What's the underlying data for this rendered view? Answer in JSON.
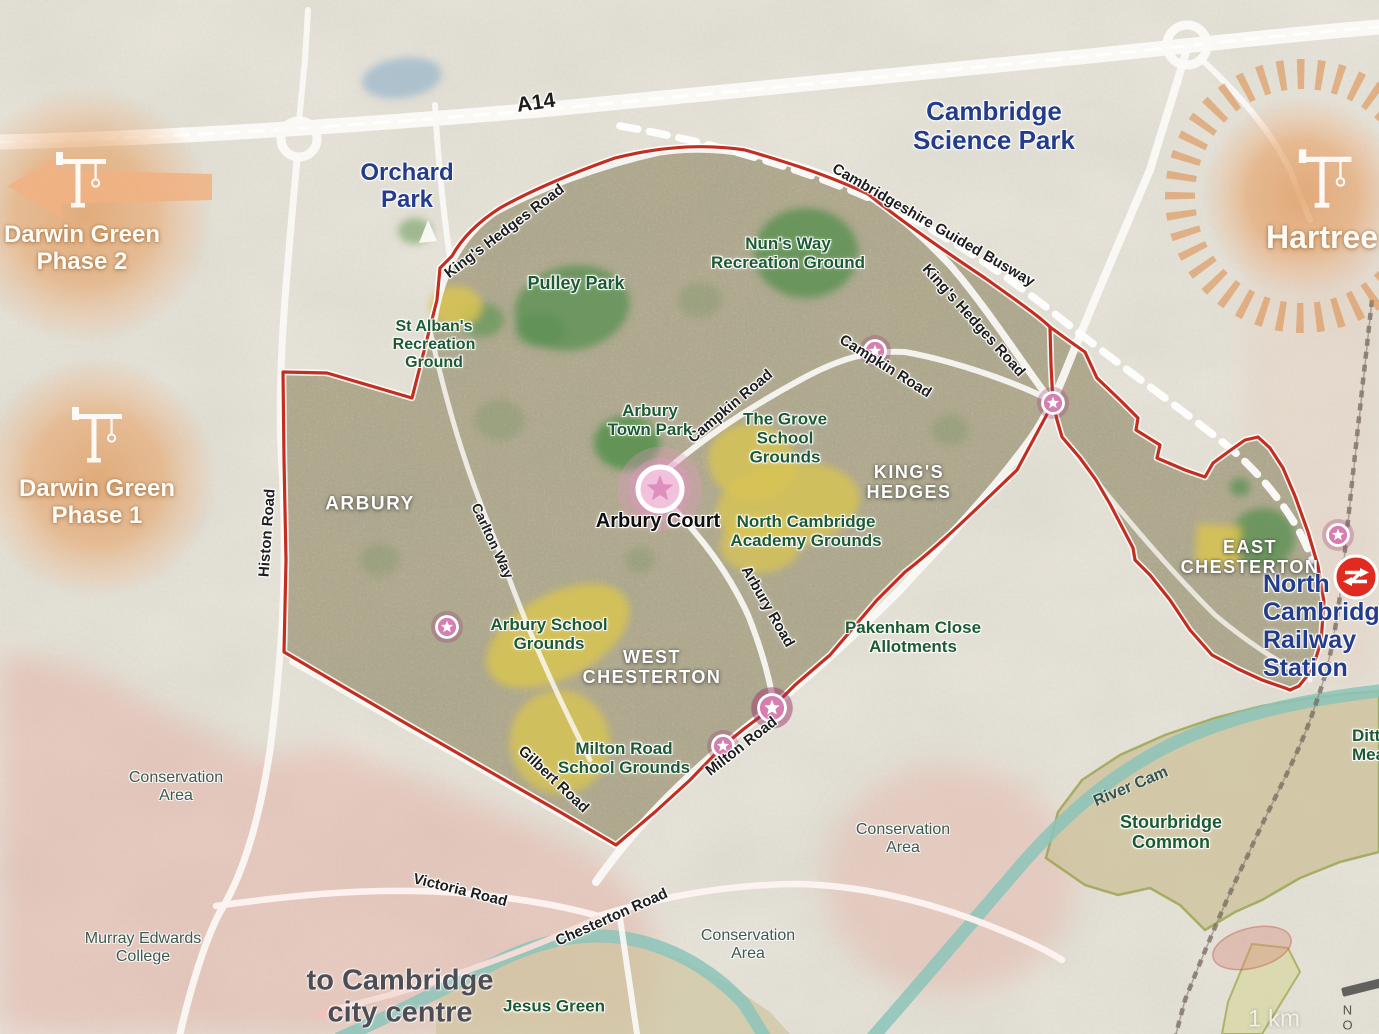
{
  "map_title": "North Cambridge area map",
  "colors": {
    "boundary_red": "#c22f21",
    "water_teal": "#8cc4ba",
    "development_orange": "#e9a873",
    "marker_pink": "#d47fae",
    "rail_red": "#e02c20",
    "label_navy": "#243d8b",
    "label_green": "#1c5a33",
    "region_white": "#ffffff",
    "field_yellow": "#d8c452",
    "park_green": "#5d9154",
    "common_tan": "#cfc49f"
  },
  "scale": {
    "label": "1 km"
  },
  "compass": {
    "label": "N O"
  },
  "labels": [
    {
      "name": "road-label-a14",
      "text": "A14",
      "x": 536,
      "y": 103,
      "rot": -8,
      "size": 21,
      "cls": "road"
    },
    {
      "name": "road-label-kings-hedges-west",
      "text": "King's Hedges Road",
      "x": 505,
      "y": 232,
      "rot": -37,
      "size": 15,
      "cls": "road"
    },
    {
      "name": "road-label-kings-hedges-east",
      "text": "King's Hedges Road",
      "x": 973,
      "y": 321,
      "rot": 48,
      "size": 15,
      "cls": "road"
    },
    {
      "name": "road-label-guided-busway",
      "text": "Cambridgeshire Guided Busway",
      "x": 933,
      "y": 226,
      "rot": 30,
      "size": 15,
      "cls": "road"
    },
    {
      "name": "road-label-campkin-west",
      "text": "Campkin Road",
      "x": 731,
      "y": 407,
      "rot": -40,
      "size": 15,
      "cls": "road"
    },
    {
      "name": "road-label-campkin-east",
      "text": "Campkin Road",
      "x": 885,
      "y": 367,
      "rot": 32,
      "size": 15,
      "cls": "road"
    },
    {
      "name": "road-label-histon",
      "text": "Histon Road",
      "x": 268,
      "y": 533,
      "rot": -86,
      "size": 15,
      "cls": "road"
    },
    {
      "name": "road-label-carlton-way",
      "text": "Carlton Way",
      "x": 492,
      "y": 541,
      "rot": 65,
      "size": 14,
      "cls": "road"
    },
    {
      "name": "road-label-arbury-road",
      "text": "Arbury Road",
      "x": 767,
      "y": 607,
      "rot": 60,
      "size": 15,
      "cls": "road"
    },
    {
      "name": "road-label-milton-road",
      "text": "Milton Road",
      "x": 742,
      "y": 747,
      "rot": -38,
      "size": 15,
      "cls": "road"
    },
    {
      "name": "road-label-gilbert-road",
      "text": "Gilbert Road",
      "x": 553,
      "y": 780,
      "rot": 43,
      "size": 15,
      "cls": "road"
    },
    {
      "name": "road-label-victoria-road",
      "text": "Victoria Road",
      "x": 460,
      "y": 891,
      "rot": 14,
      "size": 15,
      "cls": "road"
    },
    {
      "name": "road-label-chesterton-road",
      "text": "Chesterton Road",
      "x": 612,
      "y": 918,
      "rot": -24,
      "size": 15,
      "cls": "road"
    },
    {
      "name": "river-cam-label",
      "text": "River Cam",
      "x": 1131,
      "y": 787,
      "rot": -23,
      "size": 16,
      "cls": "river"
    },
    {
      "name": "orchard-park-label",
      "text": "Orchard\nPark",
      "x": 407,
      "y": 187,
      "rot": 0,
      "size": 24,
      "cls": "navy"
    },
    {
      "name": "cambridge-science-park-label",
      "text": "Cambridge\nScience Park",
      "x": 994,
      "y": 126,
      "rot": 0,
      "size": 26,
      "cls": "navy"
    },
    {
      "name": "north-cambridge-station-label",
      "text": "North Cambridge\nRailway Station",
      "x": 1263,
      "y": 626,
      "rot": 0,
      "size": 25,
      "cls": "navy",
      "align": "left"
    },
    {
      "name": "darwin-green-phase-2-label",
      "text": "Darwin Green\nPhase 2",
      "x": 82,
      "y": 249,
      "rot": 0,
      "size": 24,
      "cls": "white-big"
    },
    {
      "name": "darwin-green-phase-1-label",
      "text": "Darwin Green\nPhase 1",
      "x": 97,
      "y": 503,
      "rot": 0,
      "size": 24,
      "cls": "white-big"
    },
    {
      "name": "hartree-label",
      "text": "Hartree",
      "x": 1322,
      "y": 238,
      "rot": 0,
      "size": 32,
      "cls": "white-big"
    },
    {
      "name": "region-label-arbury",
      "text": "ARBURY",
      "x": 370,
      "y": 504,
      "rot": 0,
      "size": 19,
      "cls": "region"
    },
    {
      "name": "region-label-kings-hedges",
      "text": "KING'S\nHEDGES",
      "x": 909,
      "y": 482,
      "rot": 0,
      "size": 18,
      "cls": "region"
    },
    {
      "name": "region-label-west-chesterton",
      "text": "WEST\nCHESTERTON",
      "x": 652,
      "y": 667,
      "rot": 0,
      "size": 18,
      "cls": "region"
    },
    {
      "name": "region-label-east-chesterton",
      "text": "EAST\nCHESTERTON",
      "x": 1250,
      "y": 557,
      "rot": 0,
      "size": 18,
      "cls": "region"
    },
    {
      "name": "pulley-park-label",
      "text": "Pulley Park",
      "x": 576,
      "y": 283,
      "rot": 0,
      "size": 18,
      "cls": "green"
    },
    {
      "name": "nuns-way-recreation-label",
      "text": "Nun's Way\nRecreation Ground",
      "x": 788,
      "y": 253,
      "rot": 0,
      "size": 17,
      "cls": "green"
    },
    {
      "name": "st-albans-recreation-label",
      "text": "St Alban's\nRecreation\nGround",
      "x": 434,
      "y": 345,
      "rot": 0,
      "size": 16,
      "cls": "green"
    },
    {
      "name": "arbury-town-park-label",
      "text": "Arbury\nTown Park",
      "x": 650,
      "y": 420,
      "rot": 0,
      "size": 17,
      "cls": "green"
    },
    {
      "name": "grove-school-grounds-label",
      "text": "The Grove\nSchool\nGrounds",
      "x": 785,
      "y": 438,
      "rot": 0,
      "size": 17,
      "cls": "green"
    },
    {
      "name": "north-cambridge-academy-label",
      "text": "North Cambridge\nAcademy  Grounds",
      "x": 806,
      "y": 531,
      "rot": 0,
      "size": 17,
      "cls": "green"
    },
    {
      "name": "arbury-school-grounds-label",
      "text": "Arbury School\nGrounds",
      "x": 549,
      "y": 634,
      "rot": 0,
      "size": 17,
      "cls": "green"
    },
    {
      "name": "milton-road-school-label",
      "text": "Milton Road\nSchool Grounds",
      "x": 624,
      "y": 758,
      "rot": 0,
      "size": 17,
      "cls": "green"
    },
    {
      "name": "pakenham-close-allotments-label",
      "text": "Pakenham Close\nAllotments",
      "x": 913,
      "y": 637,
      "rot": 0,
      "size": 17,
      "cls": "green"
    },
    {
      "name": "jesus-green-label",
      "text": "Jesus Green",
      "x": 554,
      "y": 1006,
      "rot": 0,
      "size": 17,
      "cls": "green"
    },
    {
      "name": "stourbridge-common-label",
      "text": "Stourbridge\nCommon",
      "x": 1171,
      "y": 832,
      "rot": 0,
      "size": 18,
      "cls": "green"
    },
    {
      "name": "ditton-meadows-label",
      "text": "Ditton\nMeadows",
      "x": 1352,
      "y": 745,
      "rot": 0,
      "size": 17,
      "cls": "green",
      "align": "left"
    },
    {
      "name": "conservation-area-label-1",
      "text": "Conservation\nArea",
      "x": 176,
      "y": 787,
      "rot": 0,
      "size": 16,
      "cls": "slate"
    },
    {
      "name": "conservation-area-label-2",
      "text": "Conservation\nArea",
      "x": 903,
      "y": 839,
      "rot": 0,
      "size": 16,
      "cls": "slate"
    },
    {
      "name": "conservation-area-label-3",
      "text": "Conservation\nArea",
      "x": 748,
      "y": 945,
      "rot": 0,
      "size": 16,
      "cls": "slate"
    },
    {
      "name": "arbury-court-label",
      "text": "Arbury Court",
      "x": 658,
      "y": 521,
      "rot": 0,
      "size": 20,
      "cls": "black"
    },
    {
      "name": "murray-edwards-college-label",
      "text": "Murray Edwards\nCollege",
      "x": 143,
      "y": 948,
      "rot": 0,
      "size": 16,
      "cls": "slate"
    },
    {
      "name": "to-city-centre-label",
      "text": "to Cambridge\ncity centre",
      "x": 400,
      "y": 997,
      "rot": 0,
      "size": 29,
      "cls": "gray-big"
    },
    {
      "name": "scale-label",
      "text": "1 km",
      "x": 1274,
      "y": 1020,
      "rot": 0,
      "size": 24,
      "cls": "scale"
    },
    {
      "name": "compass-letters",
      "text": "N O",
      "x": 1352,
      "y": 1018,
      "rot": 0,
      "size": 13,
      "cls": "compass"
    }
  ],
  "markers": [
    {
      "name": "star-marker-campkin-road",
      "type": "star-small",
      "x": 875,
      "y": 351
    },
    {
      "name": "star-marker-kings-hedges-junction",
      "type": "star-small",
      "x": 1053,
      "y": 403
    },
    {
      "name": "star-marker-arbury-school",
      "type": "star-small",
      "x": 447,
      "y": 627
    },
    {
      "name": "star-marker-milton-road",
      "type": "star-small",
      "x": 723,
      "y": 746
    },
    {
      "name": "star-marker-milton-arbury-junction",
      "type": "star-medium",
      "x": 772,
      "y": 708
    },
    {
      "name": "star-marker-railway-station",
      "type": "star-small",
      "x": 1338,
      "y": 535
    },
    {
      "name": "star-marker-arbury-court",
      "type": "star-large",
      "x": 660,
      "y": 489
    },
    {
      "name": "national-rail-icon",
      "type": "rail",
      "x": 1356,
      "y": 577
    }
  ],
  "cranes": [
    {
      "name": "crane-icon-darwin-green-2",
      "x": 78,
      "y": 205,
      "s": 1
    },
    {
      "name": "crane-icon-darwin-green-1",
      "x": 94,
      "y": 460,
      "s": 1
    },
    {
      "name": "crane-icon-hartree",
      "x": 1322,
      "y": 205,
      "s": 1.05
    }
  ]
}
